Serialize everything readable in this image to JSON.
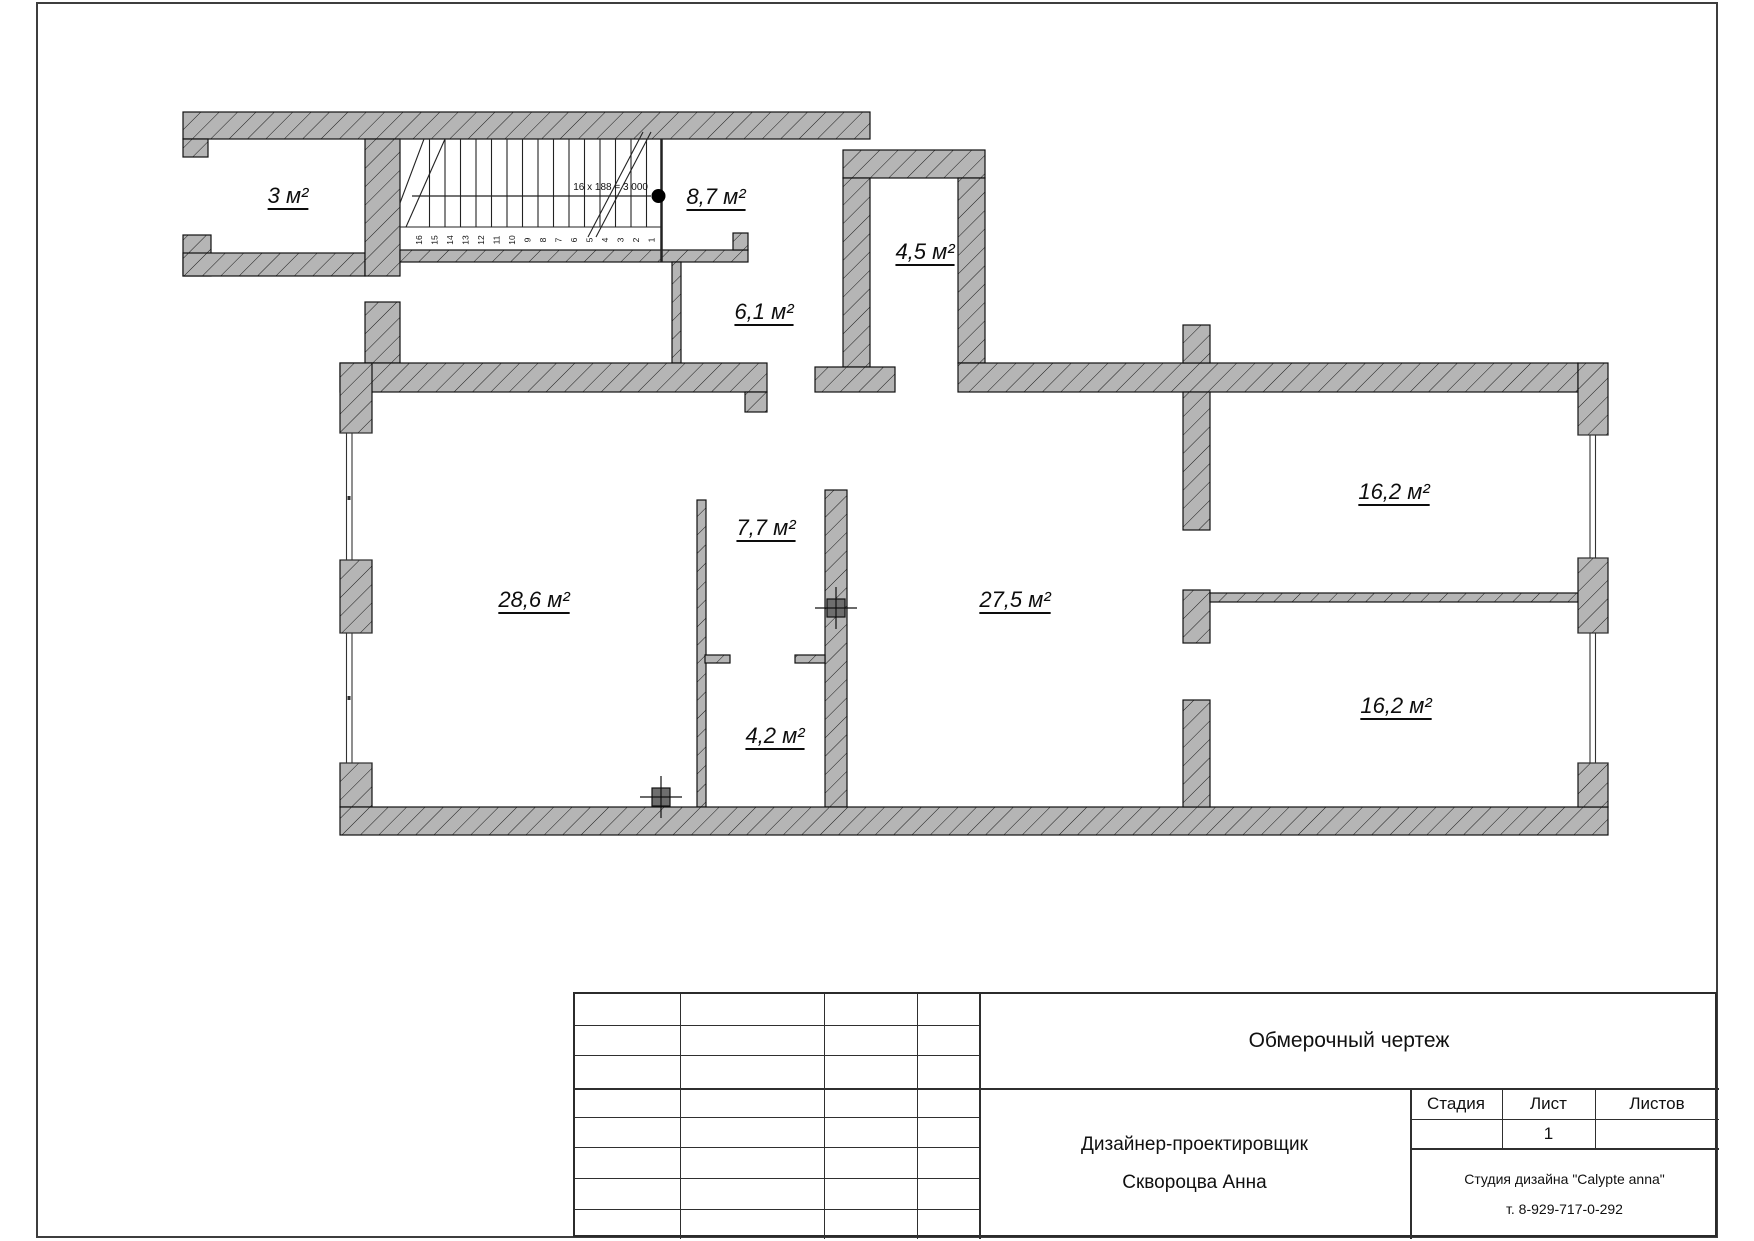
{
  "plan": {
    "rooms": [
      {
        "id": "3",
        "label": "3 м²",
        "x": 288,
        "y": 196
      },
      {
        "id": "8-7",
        "label": "8,7 м²",
        "x": 716,
        "y": 197
      },
      {
        "id": "4-5",
        "label": "4,5 м²",
        "x": 925,
        "y": 252
      },
      {
        "id": "6-1",
        "label": "6,1 м²",
        "x": 764,
        "y": 312
      },
      {
        "id": "7-7",
        "label": "7,7 м²",
        "x": 766,
        "y": 528
      },
      {
        "id": "28-6",
        "label": "28,6 м²",
        "x": 534,
        "y": 600
      },
      {
        "id": "27-5",
        "label": "27,5 м²",
        "x": 1015,
        "y": 600
      },
      {
        "id": "16-2-upper",
        "label": "16,2 м²",
        "x": 1394,
        "y": 492
      },
      {
        "id": "16-2-lower",
        "label": "16,2 м²",
        "x": 1396,
        "y": 706
      },
      {
        "id": "4-2",
        "label": "4,2 м²",
        "x": 775,
        "y": 736
      }
    ],
    "stairs": {
      "annotation": "16 x 188 = 3 000",
      "step_count": 16
    }
  },
  "title_block": {
    "drawing_title": "Обмерочный чертеж",
    "stage_label": "Стадия",
    "sheet_label": "Лист",
    "sheets_label": "Листов",
    "sheet_number": "1",
    "designer_role": "Дизайнер-проектировщик",
    "designer_name": "Сквороцва Анна",
    "studio_name": "Студия дизайна \"Calypte anna\"",
    "studio_phone": "т. 8-929-717-0-292"
  },
  "colors": {
    "wall_fill": "#b5b5b5",
    "line": "#111111",
    "frame": "#3d3d3d"
  }
}
